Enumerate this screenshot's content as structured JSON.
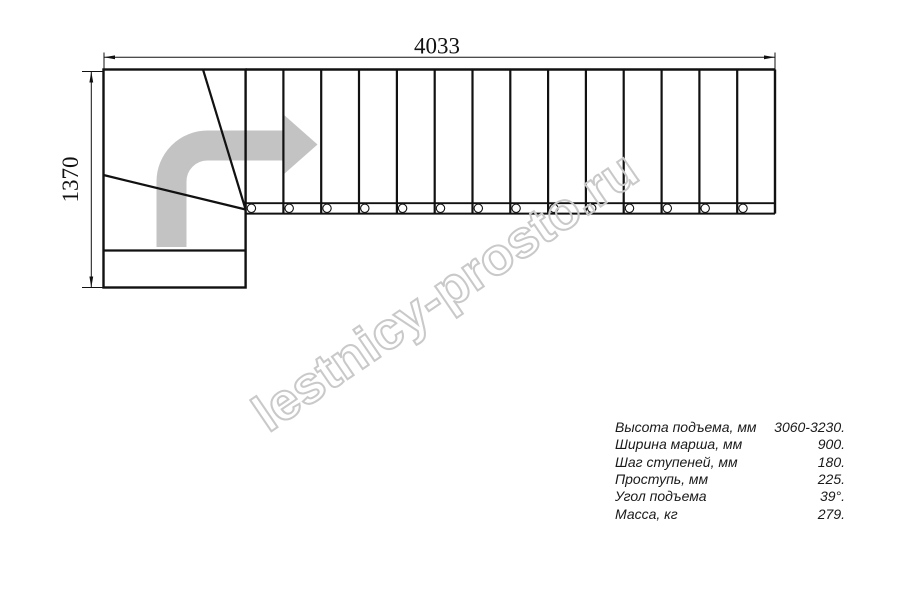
{
  "drawing": {
    "title": "stair-plan",
    "width_dimension": "4033",
    "height_dimension": "1370",
    "line_color": "#111111",
    "direction_arrow_color": "#c3c3c3",
    "watermark": {
      "text": "lestnicy-prosto.ru",
      "color": "#c9c9c9"
    },
    "straight_treads_count": 14,
    "stringer_holes_count": 14,
    "winder_steps_count": 3
  },
  "specs": {
    "rows": [
      {
        "label": "Высота подъема, мм",
        "value": "3060-3230."
      },
      {
        "label": "Ширина марша, мм",
        "value": "900."
      },
      {
        "label": "Шаг ступеней, мм",
        "value": "180."
      },
      {
        "label": "Проступь, мм",
        "value": "225."
      },
      {
        "label": "Угол подъема",
        "value": "39°."
      },
      {
        "label": "Масса, кг",
        "value": "279."
      }
    ]
  }
}
